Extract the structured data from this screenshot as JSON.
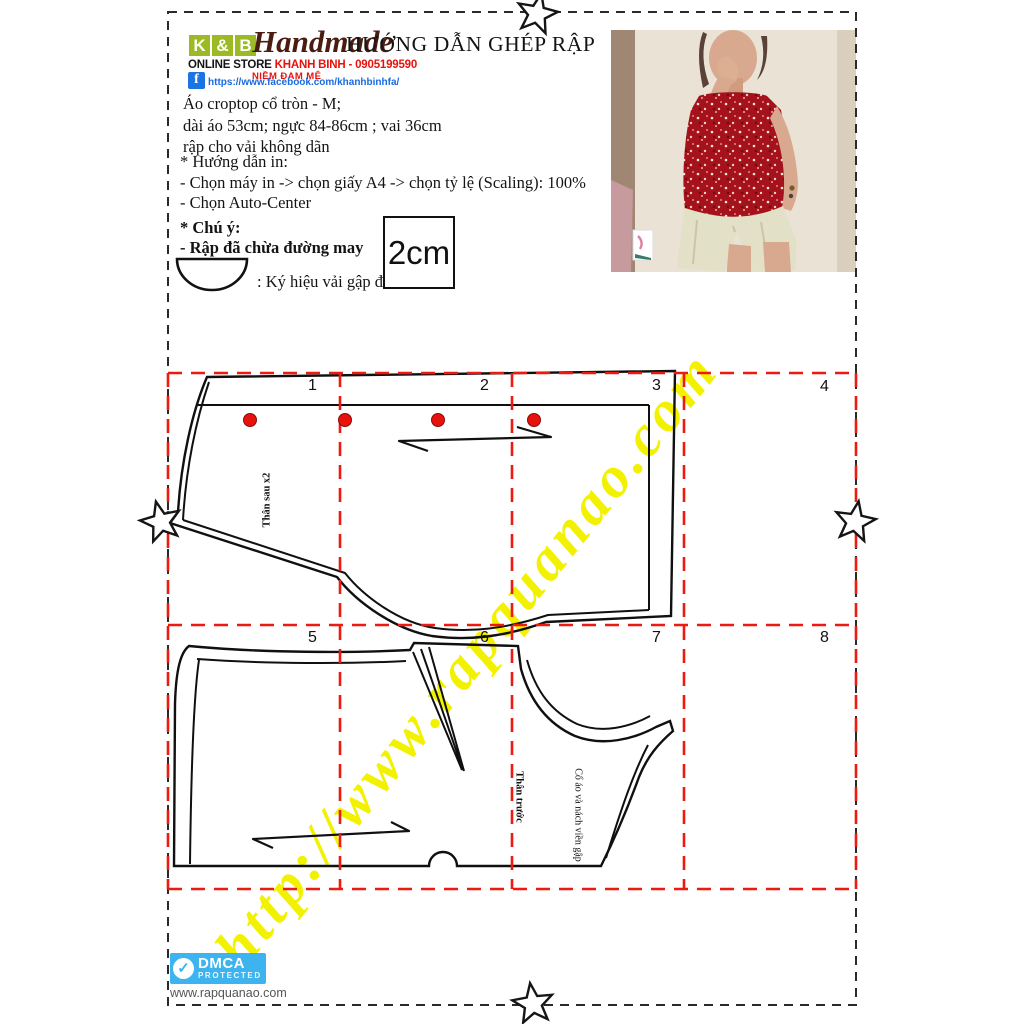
{
  "header": {
    "logo": {
      "k": "K",
      "amp": "&",
      "b": "B",
      "brand": "Handmade",
      "store_label": "ONLINE STORE",
      "store_info": "KHANH BINH - 0905199590",
      "slogan": "NIỀM ĐAM MÊ",
      "facebook_icon": "f",
      "facebook_url": "https://www.facebook.com/khanhbinhfa/"
    },
    "title": "HƯỚNG DẪN GHÉP RẬP"
  },
  "specs": {
    "lines": [
      "Áo croptop cổ tròn - M;",
      "dài áo 53cm; ngực 84-86cm ; vai 36cm",
      "rập cho vải không dãn"
    ]
  },
  "print_guide": {
    "heading": "* Hướng dẫn in:",
    "lines": [
      "- Chọn máy in -> chọn giấy A4  -> chọn tỷ lệ (Scaling): 100%",
      "- Chọn Auto-Center"
    ]
  },
  "notes": {
    "heading": "* Chú ý:",
    "line1": "- Rập đã chừa đường may",
    "fold_symbol_label": ": Ký hiệu vải gập đôi",
    "seam_allowance": "2cm"
  },
  "grid": {
    "cells": [
      "1",
      "2",
      "3",
      "4",
      "5",
      "6",
      "7",
      "8"
    ]
  },
  "pattern_labels": {
    "back": "Thân sau x2",
    "front": "Thân trước",
    "binding": "Cổ áo và nách viền gập"
  },
  "watermark": "http://www.rapquanao.com",
  "footer": {
    "dmca_title": "DMCA",
    "dmca_subtitle": "PROTECTED",
    "dmca_check": "✓",
    "site": "www.rapquanao.com"
  },
  "colors": {
    "accent_red": "#ee1a12",
    "watermark_yellow": "#f2f200",
    "logo_green": "#9cba24",
    "brand_brown": "#4b1d10",
    "facebook_blue": "#1b74e4",
    "dmca_blue": "#3db3ef"
  }
}
